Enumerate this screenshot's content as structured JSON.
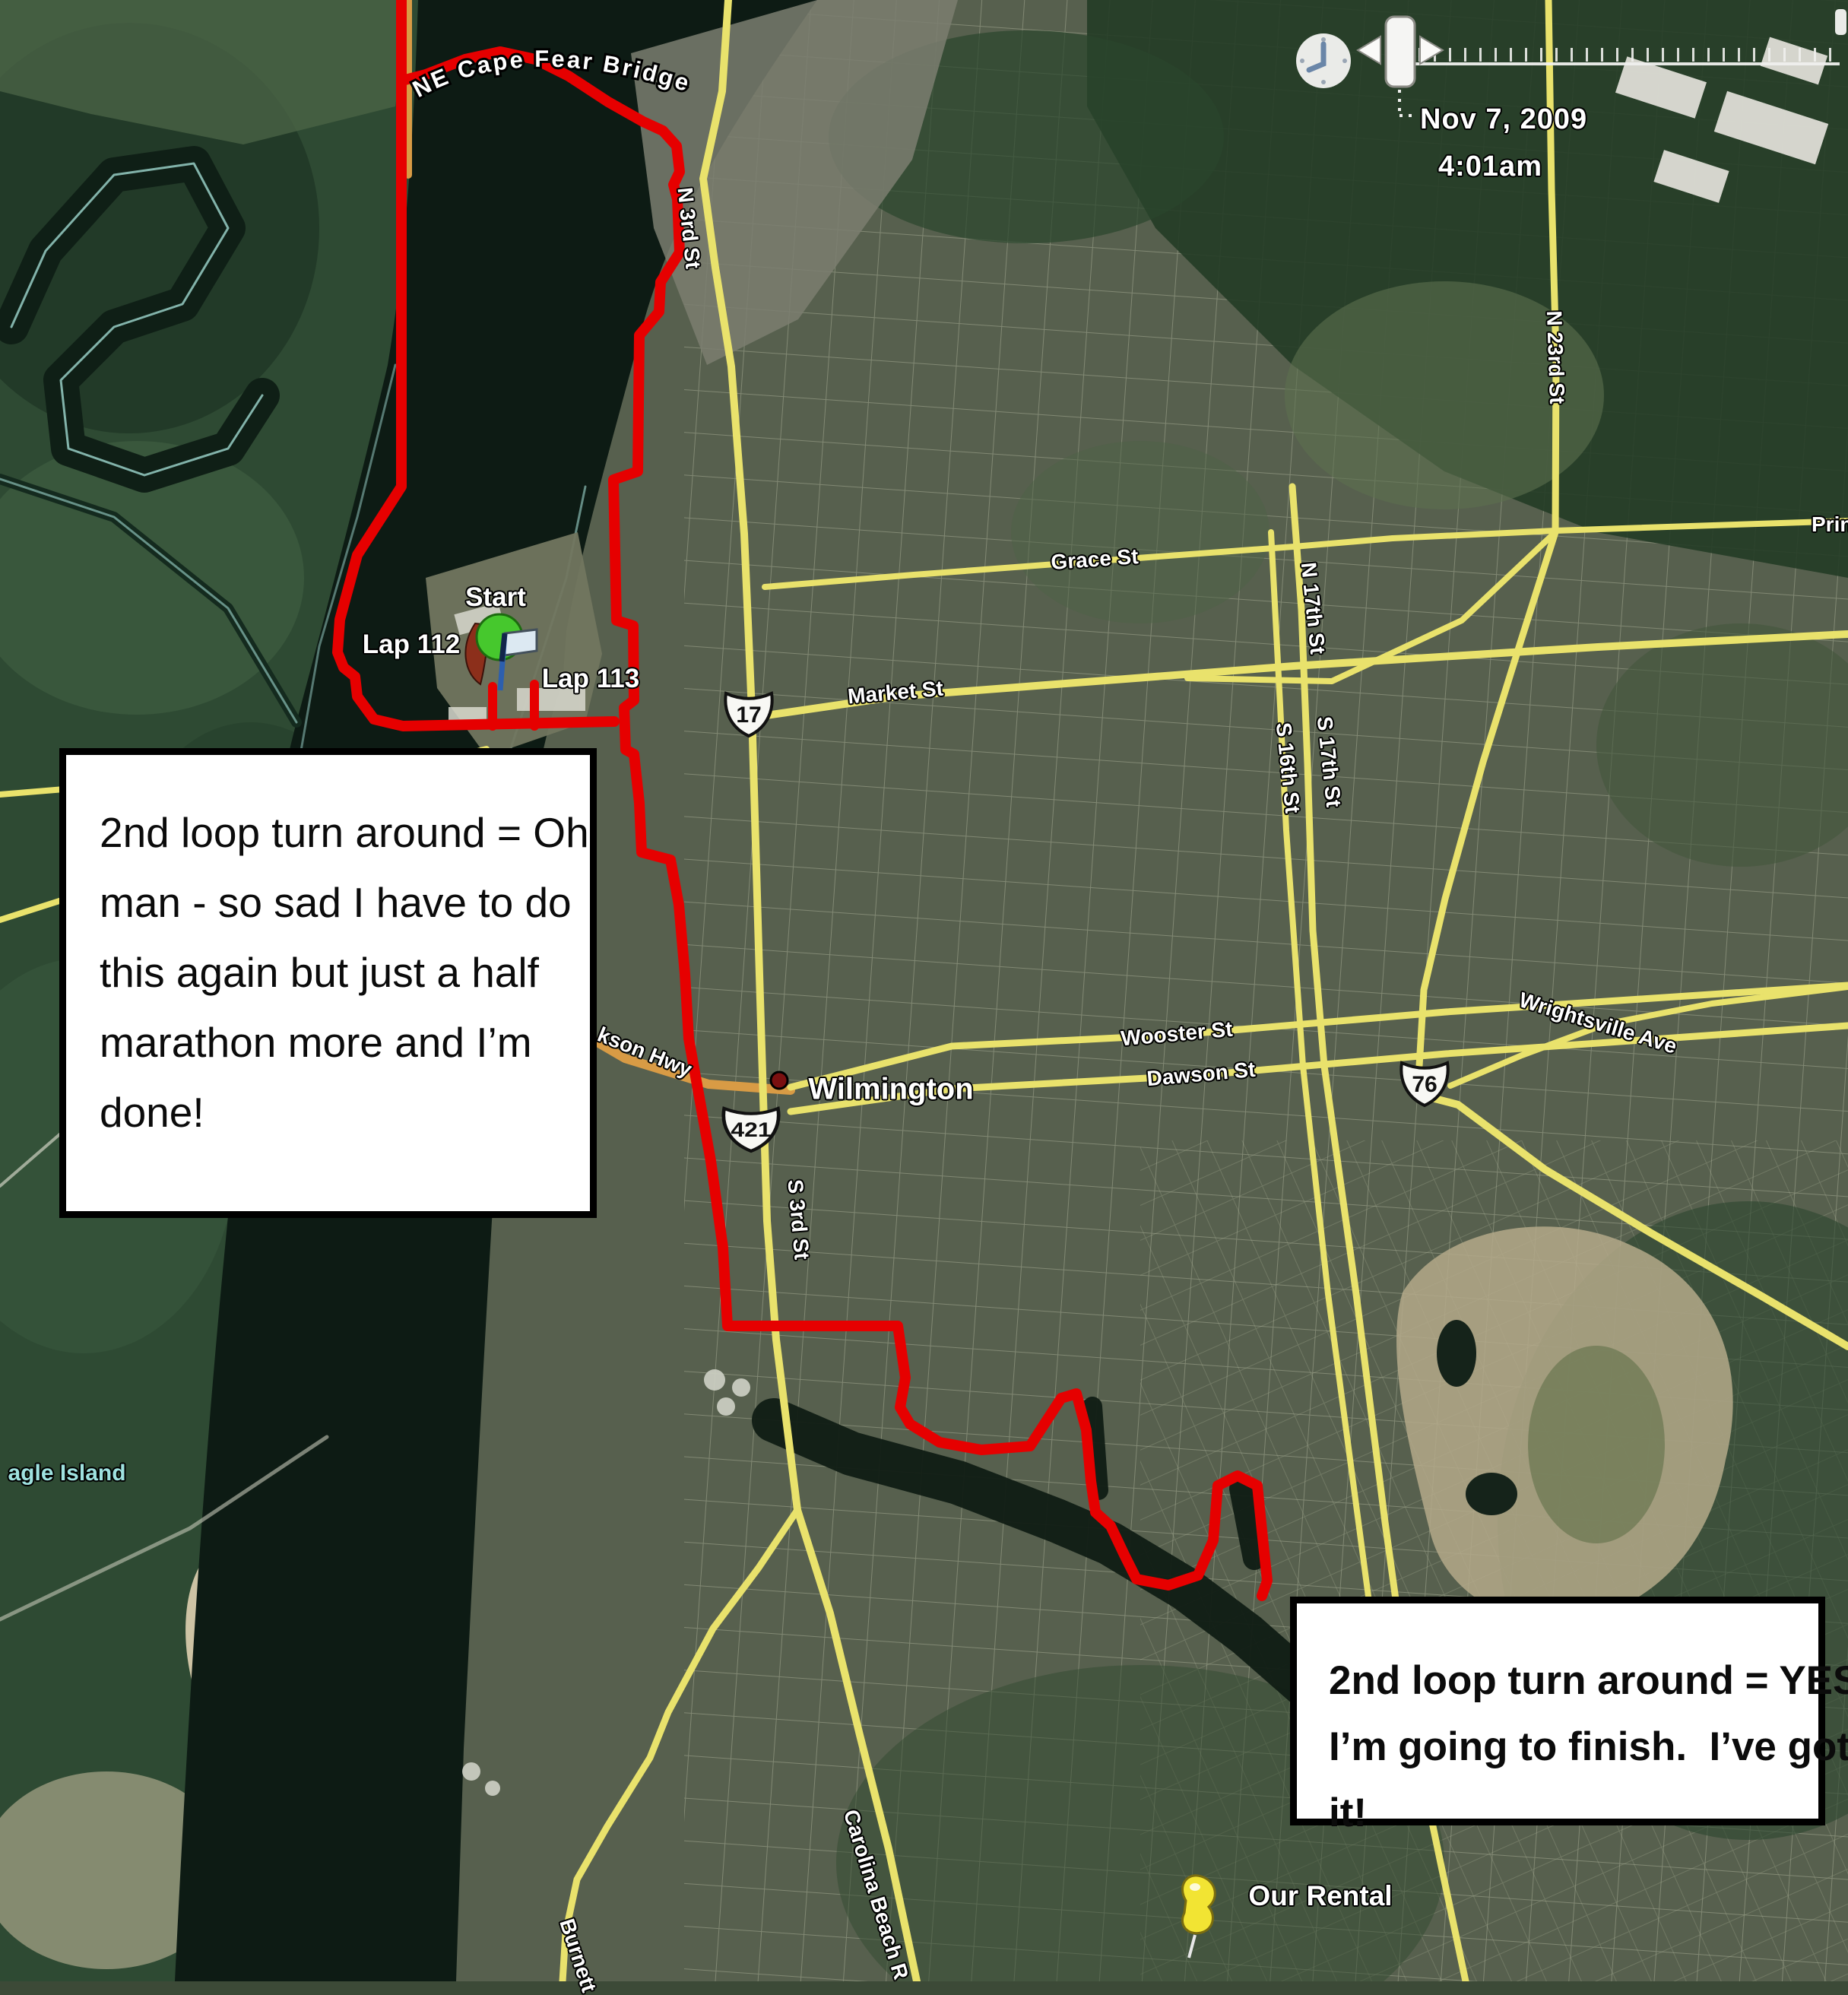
{
  "timeline": {
    "date": "Nov 7, 2009",
    "time": "4:01am"
  },
  "annotations": {
    "box1": {
      "lines": [
        "2nd loop turn around = Oh",
        "man - so sad I have to do",
        "this again but just a half",
        "marathon more and I’m",
        "done!"
      ]
    },
    "box2": {
      "lines": [
        "2nd loop turn around = YES!",
        "I’m going to finish.  I’ve got",
        "it!"
      ]
    }
  },
  "markers": {
    "start": "Start",
    "lap112": "Lap 112",
    "lap113": "Lap 113",
    "city": "Wilmington",
    "rental": "Our Rental"
  },
  "shields": {
    "us17": "17",
    "us421": "421",
    "us76": "76"
  },
  "road_labels": {
    "bridge": "NE Cape Fear Bridge",
    "n3rd": "N 3rd St",
    "s3rd": "S 3rd St",
    "grace": "Grace St",
    "market": "Market St",
    "wooster": "Wooster St",
    "dawson": "Dawson St",
    "n17th": "N 17th St",
    "s17th": "S 17th St",
    "s16th": "S 16th St",
    "n23rd": "N 23rd St",
    "princ": "Princ",
    "wrightsville": "Wrightsville Ave",
    "jackson": "kson Hwy",
    "carolina": "Carolina Beach R",
    "burnett": "Burnett",
    "eagle_island": "agle Island"
  },
  "colors": {
    "route_red": "#e60000",
    "road_yellow": "#e9e26c",
    "road_orange": "#d89b45",
    "water_dark": "#0d1b14",
    "shore_cyan": "#9fd8cf"
  },
  "route": {
    "west": [
      [
        528,
        0
      ],
      [
        528,
        640
      ],
      [
        470,
        730
      ],
      [
        447,
        815
      ],
      [
        444,
        858
      ],
      [
        452,
        878
      ],
      [
        467,
        890
      ],
      [
        470,
        916
      ],
      [
        492,
        946
      ],
      [
        530,
        955
      ],
      [
        808,
        949
      ]
    ],
    "stub1": [
      [
        648,
        955
      ],
      [
        648,
        903
      ]
    ],
    "stub2": [
      [
        703,
        955
      ],
      [
        703,
        900
      ]
    ],
    "east": [
      [
        529,
        106
      ],
      [
        560,
        98
      ],
      [
        612,
        78
      ],
      [
        658,
        68
      ],
      [
        704,
        78
      ],
      [
        748,
        100
      ],
      [
        800,
        134
      ],
      [
        846,
        160
      ],
      [
        872,
        172
      ],
      [
        890,
        192
      ],
      [
        894,
        226
      ],
      [
        886,
        243
      ],
      [
        891,
        262
      ],
      [
        894,
        332
      ],
      [
        869,
        371
      ],
      [
        867,
        410
      ],
      [
        841,
        441
      ],
      [
        839,
        620
      ],
      [
        807,
        631
      ],
      [
        811,
        816
      ],
      [
        833,
        823
      ],
      [
        834,
        921
      ],
      [
        821,
        931
      ],
      [
        823,
        986
      ],
      [
        834,
        992
      ],
      [
        841,
        1056
      ],
      [
        844,
        1121
      ],
      [
        882,
        1131
      ],
      [
        893,
        1190
      ],
      [
        901,
        1281
      ],
      [
        906,
        1366
      ],
      [
        935,
        1527
      ],
      [
        951,
        1641
      ],
      [
        957,
        1744
      ],
      [
        1181,
        1744
      ],
      [
        1191,
        1812
      ],
      [
        1184,
        1851
      ],
      [
        1197,
        1873
      ],
      [
        1236,
        1897
      ],
      [
        1291,
        1907
      ],
      [
        1355,
        1902
      ],
      [
        1396,
        1839
      ],
      [
        1416,
        1833
      ],
      [
        1429,
        1881
      ],
      [
        1435,
        1948
      ],
      [
        1441,
        1989
      ],
      [
        1461,
        2007
      ],
      [
        1479,
        2045
      ],
      [
        1495,
        2077
      ],
      [
        1537,
        2085
      ],
      [
        1576,
        2072
      ],
      [
        1596,
        2026
      ],
      [
        1602,
        1954
      ],
      [
        1628,
        1941
      ],
      [
        1654,
        1954
      ],
      [
        1660,
        2013
      ],
      [
        1667,
        2079
      ],
      [
        1660,
        2099
      ]
    ]
  },
  "roads": {
    "n3rd": [
      [
        958,
        0
      ],
      [
        950,
        120
      ],
      [
        925,
        235
      ],
      [
        941,
        352
      ],
      [
        962,
        482
      ],
      [
        979,
        702
      ],
      [
        989,
        936
      ],
      [
        999,
        1282
      ],
      [
        1009,
        1606
      ],
      [
        1021,
        1762
      ],
      [
        1049,
        1986
      ]
    ],
    "carolina_beach": [
      [
        1049,
        1986
      ],
      [
        1092,
        2122
      ],
      [
        1131,
        2282
      ],
      [
        1169,
        2432
      ],
      [
        1206,
        2606
      ]
    ],
    "burnett": [
      [
        1049,
        1986
      ],
      [
        998,
        2062
      ],
      [
        938,
        2142
      ],
      [
        879,
        2252
      ],
      [
        855,
        2312
      ],
      [
        799,
        2402
      ],
      [
        759,
        2472
      ],
      [
        744,
        2542
      ],
      [
        740,
        2606
      ]
    ],
    "market": [
      [
        1008,
        941
      ],
      [
        1180,
        916
      ],
      [
        1402,
        899
      ],
      [
        1702,
        876
      ],
      [
        2102,
        851
      ],
      [
        2431,
        834
      ]
    ],
    "grace": [
      [
        1006,
        772
      ],
      [
        1202,
        756
      ],
      [
        1442,
        738
      ],
      [
        1702,
        719
      ],
      [
        1832,
        708
      ]
    ],
    "princess": [
      [
        1832,
        708
      ],
      [
        2046,
        698
      ],
      [
        2431,
        685
      ]
    ],
    "princess_diag": [
      [
        2046,
        700
      ],
      [
        1923,
        816
      ],
      [
        1752,
        896
      ],
      [
        1562,
        892
      ]
    ],
    "wooster": [
      [
        1040,
        1430
      ],
      [
        1252,
        1376
      ],
      [
        1550,
        1361
      ],
      [
        1902,
        1331
      ],
      [
        2431,
        1296
      ]
    ],
    "dawson": [
      [
        1040,
        1462
      ],
      [
        1254,
        1432
      ],
      [
        1582,
        1414
      ],
      [
        1902,
        1386
      ],
      [
        2431,
        1349
      ]
    ],
    "s17th": [
      [
        1700,
        640
      ],
      [
        1712,
        802
      ],
      [
        1720,
        1004
      ],
      [
        1727,
        1224
      ],
      [
        1742,
        1402
      ],
      [
        1784,
        1702
      ],
      [
        1822,
        2002
      ],
      [
        1862,
        2292
      ],
      [
        1895,
        2450
      ],
      [
        1928,
        2606
      ]
    ],
    "s16th": [
      [
        1672,
        700
      ],
      [
        1684,
        928
      ],
      [
        1692,
        1092
      ],
      [
        1702,
        1232
      ],
      [
        1714,
        1402
      ],
      [
        1747,
        1702
      ],
      [
        1787,
        2002
      ],
      [
        1827,
        2302
      ]
    ],
    "n23rd": [
      [
        2037,
        0
      ],
      [
        2041,
        250
      ],
      [
        2047,
        470
      ],
      [
        2046,
        700
      ],
      [
        2001,
        842
      ],
      [
        1951,
        1002
      ],
      [
        1901,
        1182
      ],
      [
        1873,
        1302
      ],
      [
        1867,
        1402
      ]
    ],
    "oleander": [
      [
        1876,
        1442
      ],
      [
        1918,
        1453
      ],
      [
        2032,
        1538
      ],
      [
        2174,
        1623
      ],
      [
        2316,
        1704
      ],
      [
        2431,
        1771
      ]
    ],
    "wrightsville": [
      [
        1908,
        1428
      ],
      [
        2002,
        1388
      ],
      [
        2112,
        1347
      ],
      [
        2252,
        1320
      ],
      [
        2431,
        1298
      ]
    ],
    "eagle1": [
      [
        0,
        1045
      ],
      [
        180,
        1030
      ],
      [
        400,
        1013
      ],
      [
        560,
        1005
      ],
      [
        640,
        985
      ]
    ],
    "eagle2": [
      [
        0,
        1210
      ],
      [
        250,
        1130
      ],
      [
        430,
        1050
      ],
      [
        560,
        1010
      ],
      [
        640,
        988
      ]
    ],
    "bridge_orange": [
      [
        430,
        1206
      ],
      [
        562,
        1256
      ],
      [
        702,
        1322
      ],
      [
        822,
        1392
      ],
      [
        932,
        1426
      ],
      [
        1040,
        1434
      ]
    ],
    "top421_orange": [
      [
        537,
        0
      ],
      [
        537,
        230
      ]
    ]
  },
  "water": {
    "creek": [
      [
        1018,
        1868
      ],
      [
        1120,
        1912
      ],
      [
        1260,
        1950
      ],
      [
        1390,
        2000
      ],
      [
        1460,
        2030
      ],
      [
        1560,
        2090
      ],
      [
        1640,
        2150
      ],
      [
        1720,
        2220
      ],
      [
        1800,
        2270
      ],
      [
        1900,
        2310
      ],
      [
        2020,
        2345
      ],
      [
        2100,
        2362
      ]
    ],
    "creek_finger1": [
      [
        1437,
        1850
      ],
      [
        1445,
        1960
      ]
    ],
    "creek_finger2": [
      [
        1632,
        1958
      ],
      [
        1650,
        2050
      ]
    ],
    "oxbow": [
      [
        15,
        430
      ],
      [
        60,
        330
      ],
      [
        150,
        230
      ],
      [
        255,
        215
      ],
      [
        300,
        300
      ],
      [
        240,
        400
      ],
      [
        150,
        430
      ],
      [
        80,
        500
      ],
      [
        90,
        590
      ],
      [
        190,
        625
      ],
      [
        300,
        590
      ],
      [
        345,
        520
      ]
    ]
  }
}
